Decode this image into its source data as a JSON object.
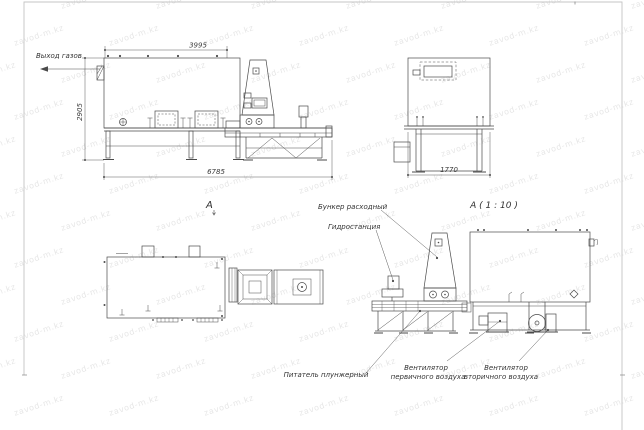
{
  "drawing": {
    "type": "engineering-assembly-drawing",
    "views": {
      "side_view": {
        "labels": {
          "gas_outlet": "Выход газов"
        },
        "dimensions": {
          "top_width": "3995",
          "left_height": "2905",
          "overall_length": "6785"
        }
      },
      "end_view": {
        "dimensions": {
          "bottom_width": "1770"
        }
      },
      "plan_view": {
        "view_label": "А"
      },
      "detail_view": {
        "view_label": "А ( 1 : 10 )",
        "callouts": {
          "feed_hopper": "Бункер расходный",
          "hydraulic_station": "Гидростанция",
          "plunger_feeder": "Питатель плунжерный",
          "primary_fan_line1": "Вентилятор",
          "primary_fan_line2": "первичного воздуха",
          "secondary_fan_line1": "Вентилятор",
          "secondary_fan_line2": "вторичного воздуха"
        }
      }
    },
    "colors": {
      "line": "#4a4a4a",
      "dim_line": "#5a5a5a",
      "frame": "#c4c4c4",
      "text": "#333333",
      "background": "#ffffff",
      "watermark": "#b9b9b9"
    }
  },
  "watermark": {
    "text": "zavod-m.kz",
    "color": "#b9b9b9"
  }
}
